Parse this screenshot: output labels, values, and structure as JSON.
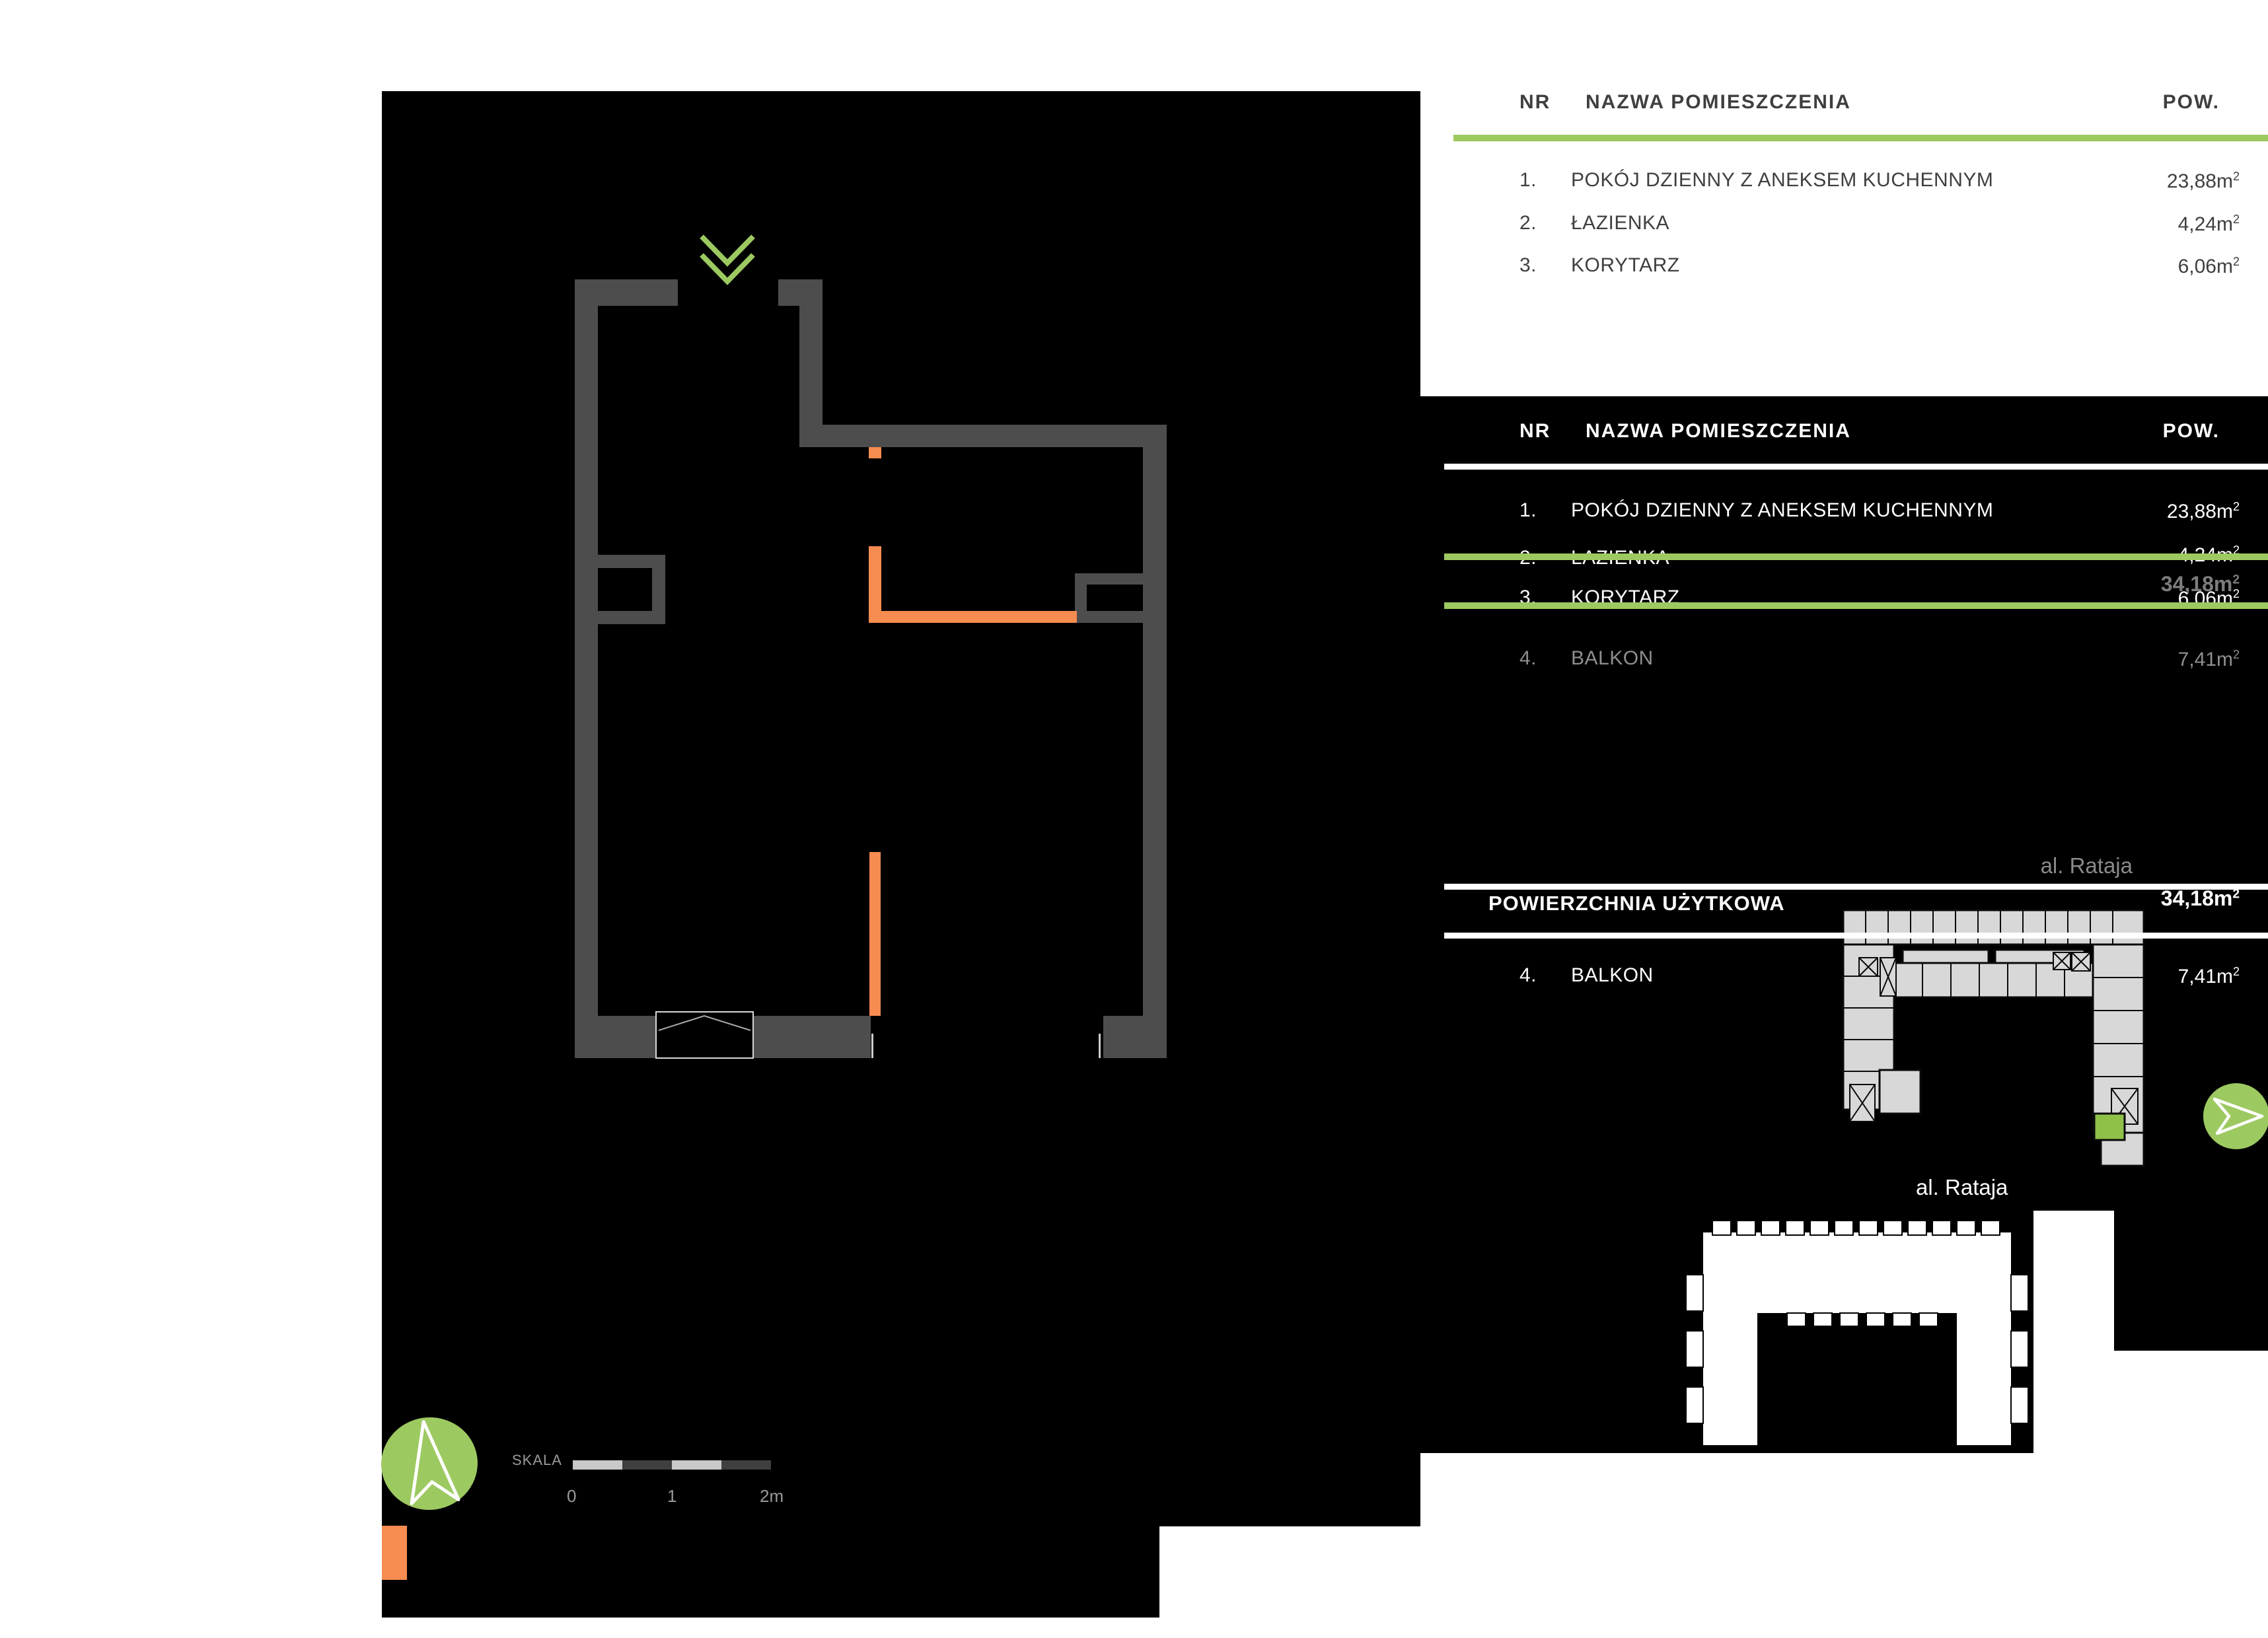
{
  "palette": {
    "green": "#9dc961",
    "orange": "#f78c50",
    "wall_gray": "#4d4d4d",
    "plan_fill": "#d8d8d8",
    "unit_green": "#8fc148"
  },
  "legend_top": {
    "col_nr": "NR",
    "col_name": "NAZWA POMIESZCZENIA",
    "col_area": "POW.",
    "rows": [
      {
        "nr": "1.",
        "name": "POKÓJ DZIENNY Z ANEKSEM KUCHENNYM",
        "area": "23,88m",
        "sup": "2"
      },
      {
        "nr": "2.",
        "name": "ŁAZIENKA",
        "area": "4,24m",
        "sup": "2"
      },
      {
        "nr": "3.",
        "name": "KORYTARZ",
        "area": "6,06m",
        "sup": "2"
      }
    ]
  },
  "legend_dark": {
    "col_nr": "NR",
    "col_name": "NAZWA POMIESZCZENIA",
    "col_area": "POW.",
    "rows": [
      {
        "nr": "1.",
        "name": "POKÓJ DZIENNY Z ANEKSEM KUCHENNYM",
        "area": "23,88m",
        "sup": "2"
      },
      {
        "nr": "2.",
        "name": "ŁAZIENKA",
        "area": "4,24m",
        "sup": "2"
      },
      {
        "nr": "3.",
        "name": "KORYTARZ",
        "area": "6,06m",
        "sup": "2"
      }
    ],
    "total_ghost": {
      "area": "34,18m",
      "sup": "2"
    },
    "balcony_row": {
      "nr": "4.",
      "name": "BALKON",
      "area": "7,41m",
      "sup": "2"
    },
    "street": "al. Rataja"
  },
  "summary": {
    "label": "POWIERZCHNIA UŻYTKOWA",
    "area": "34,18m",
    "sup": "2",
    "balcony_row": {
      "nr": "4.",
      "name": "BALKON",
      "area": "7,41m",
      "sup": "2"
    }
  },
  "siteplan_bottom": {
    "street": "al. Rataja"
  },
  "scale": {
    "label": "SKALA",
    "tick0": "0",
    "tick1": "1",
    "tick2": "2m"
  },
  "icons": {
    "entrance": "double-chevron-down-icon",
    "direction_badge": "paper-plane-icon",
    "north_badge": "north-arrow-icon"
  }
}
